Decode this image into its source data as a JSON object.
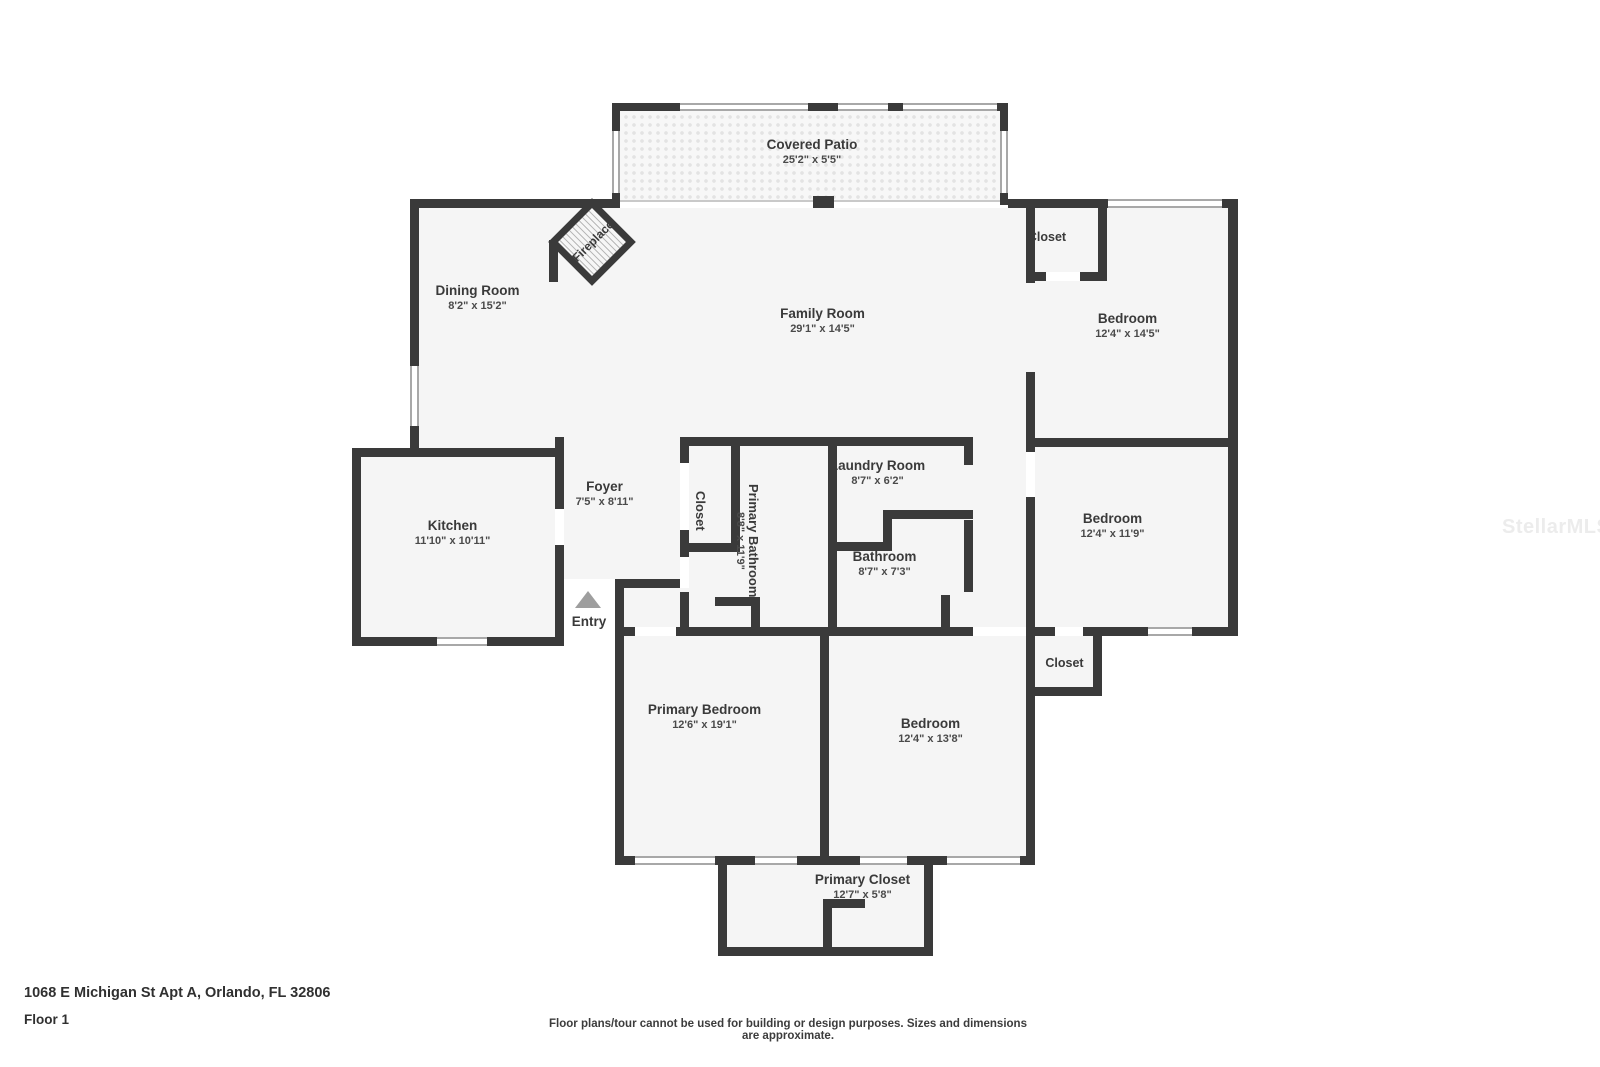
{
  "colors": {
    "wall": "#3a3a3a",
    "floor": "#f5f5f5",
    "text": "#3a3a3a",
    "dims_text": "#4a4a4a",
    "window_line": "#a8a8a8",
    "thin_line": "#c9c9c9",
    "entry_arrow": "#9e9e9e",
    "watermark": "#ececec",
    "patio_dot": "#e3e3e3"
  },
  "watermark": "StellarMLS",
  "rooms": {
    "covered_patio": {
      "name": "Covered Patio",
      "dims": "25'2\" x 5'5\""
    },
    "dining_room": {
      "name": "Dining Room",
      "dims": "8'2\" x 15'2\""
    },
    "family_room": {
      "name": "Family Room",
      "dims": "29'1\" x 14'5\""
    },
    "closet_top_right": {
      "name": "Closet"
    },
    "bedroom_top_right": {
      "name": "Bedroom",
      "dims": "12'4\" x 14'5\""
    },
    "kitchen": {
      "name": "Kitchen",
      "dims": "11'10\" x 10'11\""
    },
    "foyer": {
      "name": "Foyer",
      "dims": "7'5\" x 8'11\""
    },
    "hall_closet": {
      "name": "Closet"
    },
    "primary_bathroom": {
      "name": "Primary Bathroom",
      "dims": "8'8\" x 11'9\""
    },
    "laundry_room": {
      "name": "Laundry Room",
      "dims": "8'7\" x 6'2\""
    },
    "bathroom": {
      "name": "Bathroom",
      "dims": "8'7\" x 7'3\""
    },
    "bedroom_mid_right": {
      "name": "Bedroom",
      "dims": "12'4\" x 11'9\""
    },
    "closet_mid_right": {
      "name": "Closet"
    },
    "primary_bedroom": {
      "name": "Primary Bedroom",
      "dims": "12'6\" x 19'1\""
    },
    "bedroom_bottom": {
      "name": "Bedroom",
      "dims": "12'4\" x 13'8\""
    },
    "primary_closet": {
      "name": "Primary Closet",
      "dims": "12'7\" x 5'8\""
    },
    "fireplace": {
      "name": "Fireplace"
    },
    "entry": {
      "name": "Entry"
    }
  },
  "footer": {
    "address": "1068 E Michigan St Apt A, Orlando, FL 32806",
    "floor_label": "Floor 1",
    "disclaimer": "Floor plans/tour cannot be used for building or design purposes. Sizes and dimensions are approximate."
  }
}
